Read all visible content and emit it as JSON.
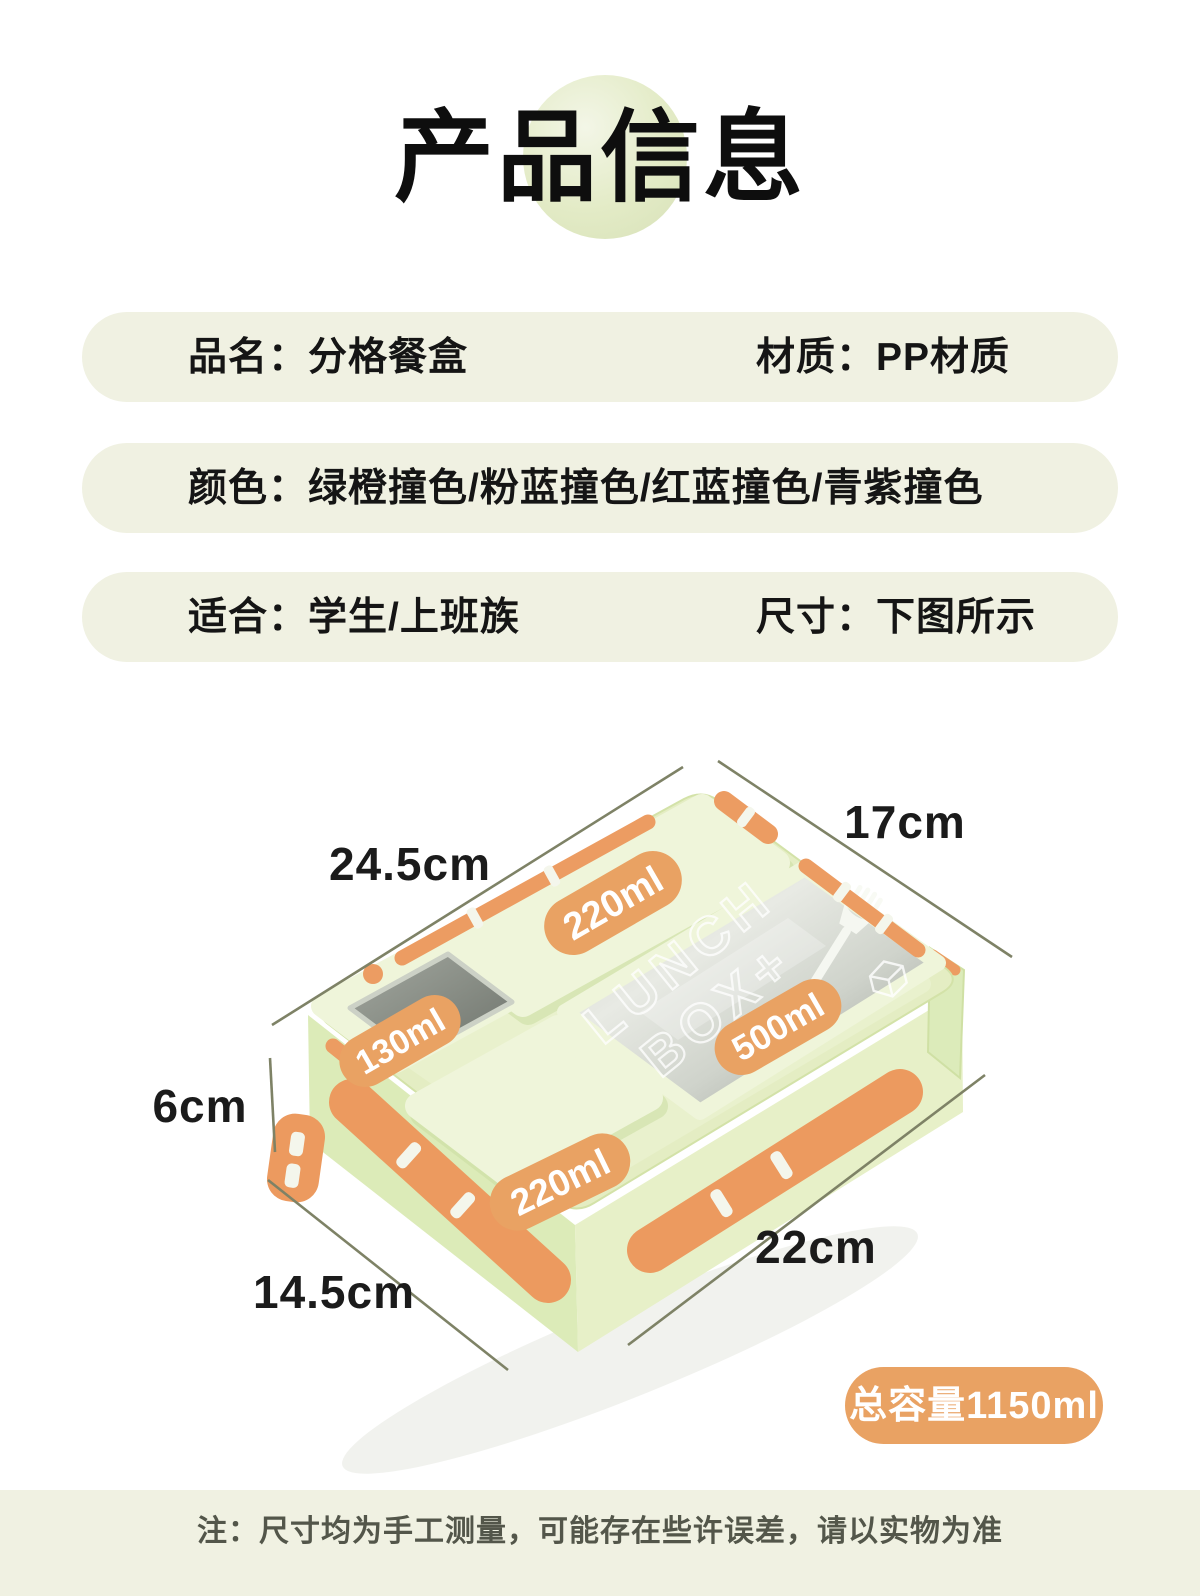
{
  "title": {
    "text": "产品信息"
  },
  "spec_bars": [
    {
      "left": "品名：分格餐盒",
      "right": "材质：PP材质"
    },
    {
      "left": "颜色：绿橙撞色/粉蓝撞色/红蓝撞色/青紫撞色",
      "right": ""
    },
    {
      "left": "适合：学生/上班族",
      "right": "尺寸：下图所示"
    }
  ],
  "diagram": {
    "dimensions": [
      {
        "id": "top-width",
        "label": "24.5cm"
      },
      {
        "id": "top-depth",
        "label": "17cm"
      },
      {
        "id": "height",
        "label": "6cm"
      },
      {
        "id": "bottom-width",
        "label": "14.5cm"
      },
      {
        "id": "bottom-depth",
        "label": "22cm"
      }
    ],
    "compartments": [
      {
        "id": "top-long",
        "label": "220ml"
      },
      {
        "id": "left-small",
        "label": "130ml"
      },
      {
        "id": "main-window",
        "label": "500ml"
      },
      {
        "id": "bottom-square",
        "label": "220ml"
      }
    ],
    "lid_text_line1": "LUNCH",
    "lid_text_line2": "BOX+"
  },
  "capacity_badge": {
    "text": "总容量1150ml"
  },
  "footer": {
    "note": "注：尺寸均为手工测量，可能存在些许误差，请以实物为准"
  },
  "colors": {
    "bar_bg": "#f0f1e2",
    "badge_orange": "#e9a263",
    "clasp_orange": "#ec9c62",
    "box_green": "#e4edc3",
    "compartment_green": "#eff5da",
    "glass_gray": "#8f948c",
    "dimension_line": "#7e8266",
    "text_dark": "#141414"
  }
}
